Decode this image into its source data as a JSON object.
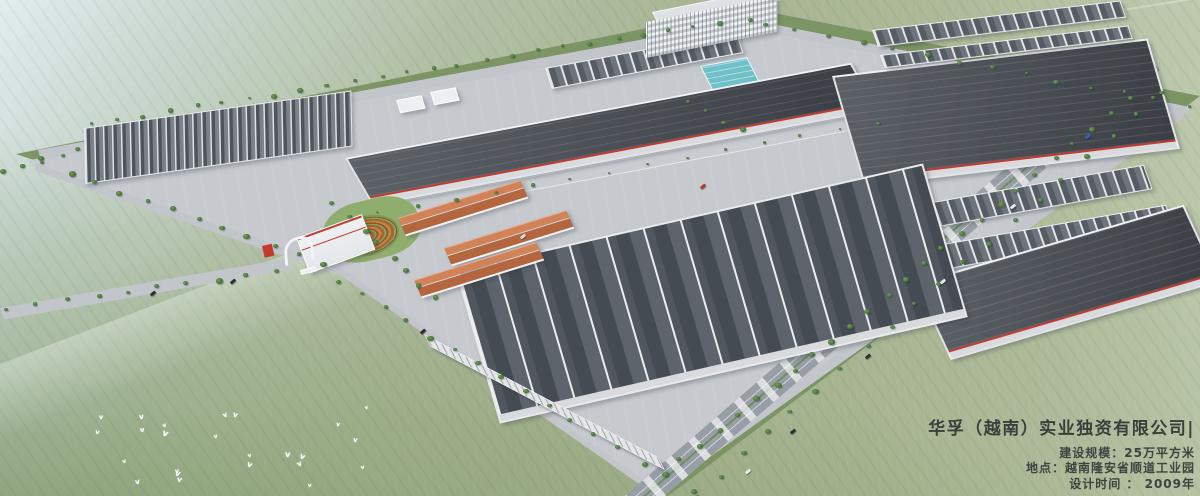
{
  "caption": {
    "title": "华孚（越南）实业独资有限公司|",
    "line1": "建设规模：25万平方米",
    "line2": "地点：越南隆安省顺道工业园",
    "line3": "设计时间 ： 2009年"
  },
  "palette": {
    "field": "#a7b491",
    "field_haze": "#dfe9ec",
    "pad": "#c6cacf",
    "roof_dark": "#4a4f57",
    "roof_mid": "#5a6068",
    "ridge_white": "#e9ebed",
    "water": "#6fc0c9",
    "terracotta": "#c0714a",
    "accent_red": "#c23b2e",
    "road": "#9aa0a7",
    "tree_green": "#4e7c46",
    "text": "#3d4440"
  }
}
